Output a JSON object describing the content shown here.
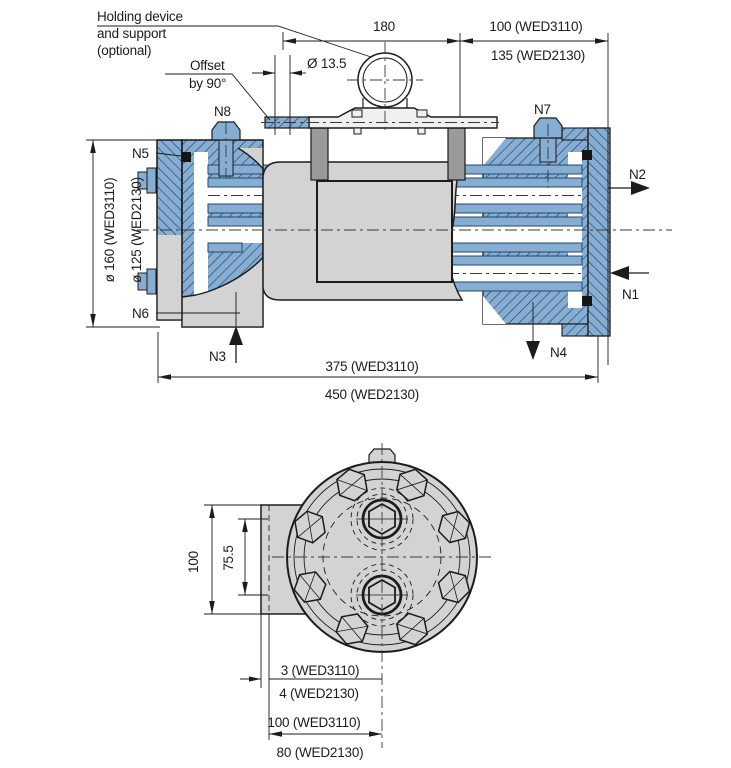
{
  "drawing": {
    "models": [
      "WED3110",
      "WED2130"
    ],
    "notes": {
      "holding": [
        "Holding device",
        "and support",
        "(optional)"
      ],
      "offset": [
        "Offset",
        "by 90°"
      ]
    },
    "ports": {
      "n1": "N1",
      "n2": "N2",
      "n3": "N3",
      "n4": "N4",
      "n5": "N5",
      "n6": "N6",
      "n7": "N7",
      "n8": "N8"
    },
    "top_view": {
      "hole_dia": "Ø 13.5",
      "span_180": "180",
      "offset_100": "100 (WED3110)",
      "offset_135": "135 (WED2130)",
      "dia_160": "ø 160  (WED3110)",
      "dia_125": "ø 125  (WED2130)",
      "length_375": "375 (WED3110)",
      "length_450": "450 (WED2130)"
    },
    "end_view": {
      "height_100": "100",
      "spacing_755": "75.5",
      "gap_3": "3 (WED3110)",
      "gap_4": "4 (WED2130)",
      "center_100": "100 (WED3110)",
      "center_80": "80 (WED2130)"
    },
    "colors": {
      "section_blue": "#86add2",
      "hatch_blue": "#1d3a5f",
      "body_gray": "#d3d3d3",
      "leg_gray": "#9a9a9a",
      "line": "#1c1c1c"
    }
  }
}
